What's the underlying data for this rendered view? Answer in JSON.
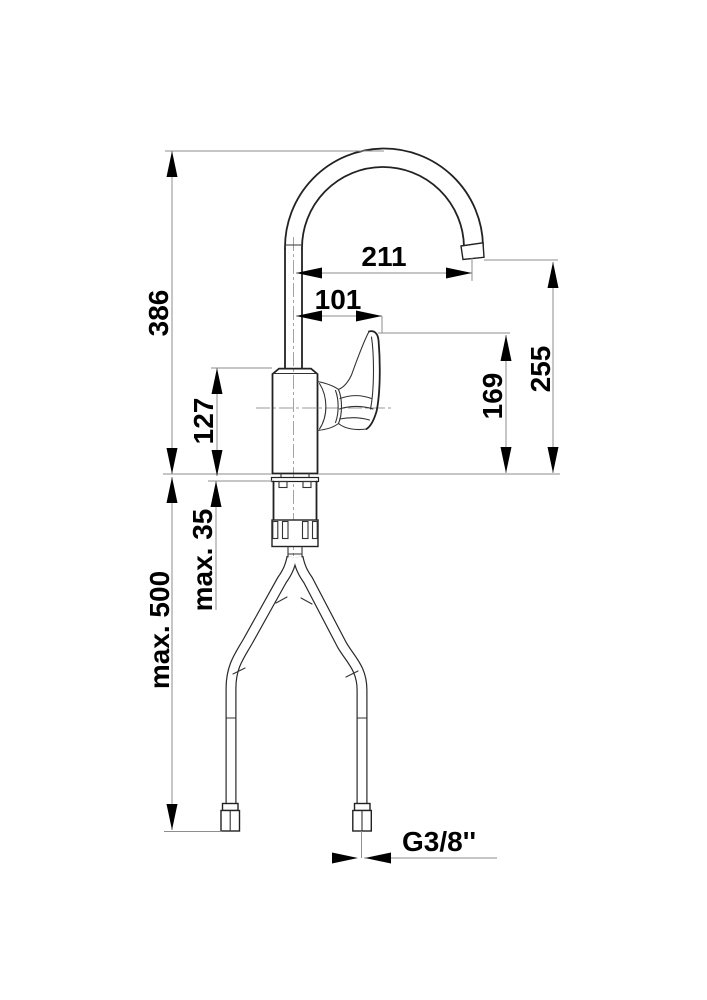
{
  "drawing": {
    "type": "faucet installation dimension drawing",
    "dimensions": {
      "overall_height": "386",
      "spout_reach": "211",
      "handle_reach": "101",
      "body_height": "127",
      "handle_height": "169",
      "outlet_height": "255",
      "max_deck_thickness": "max. 35",
      "max_hose_length": "max. 500",
      "thread_size": "G3/8''"
    },
    "colors": {
      "background": "#ffffff",
      "outline": "#222222",
      "dimension_lines": "#8e8e8e",
      "text": "#000000"
    }
  }
}
